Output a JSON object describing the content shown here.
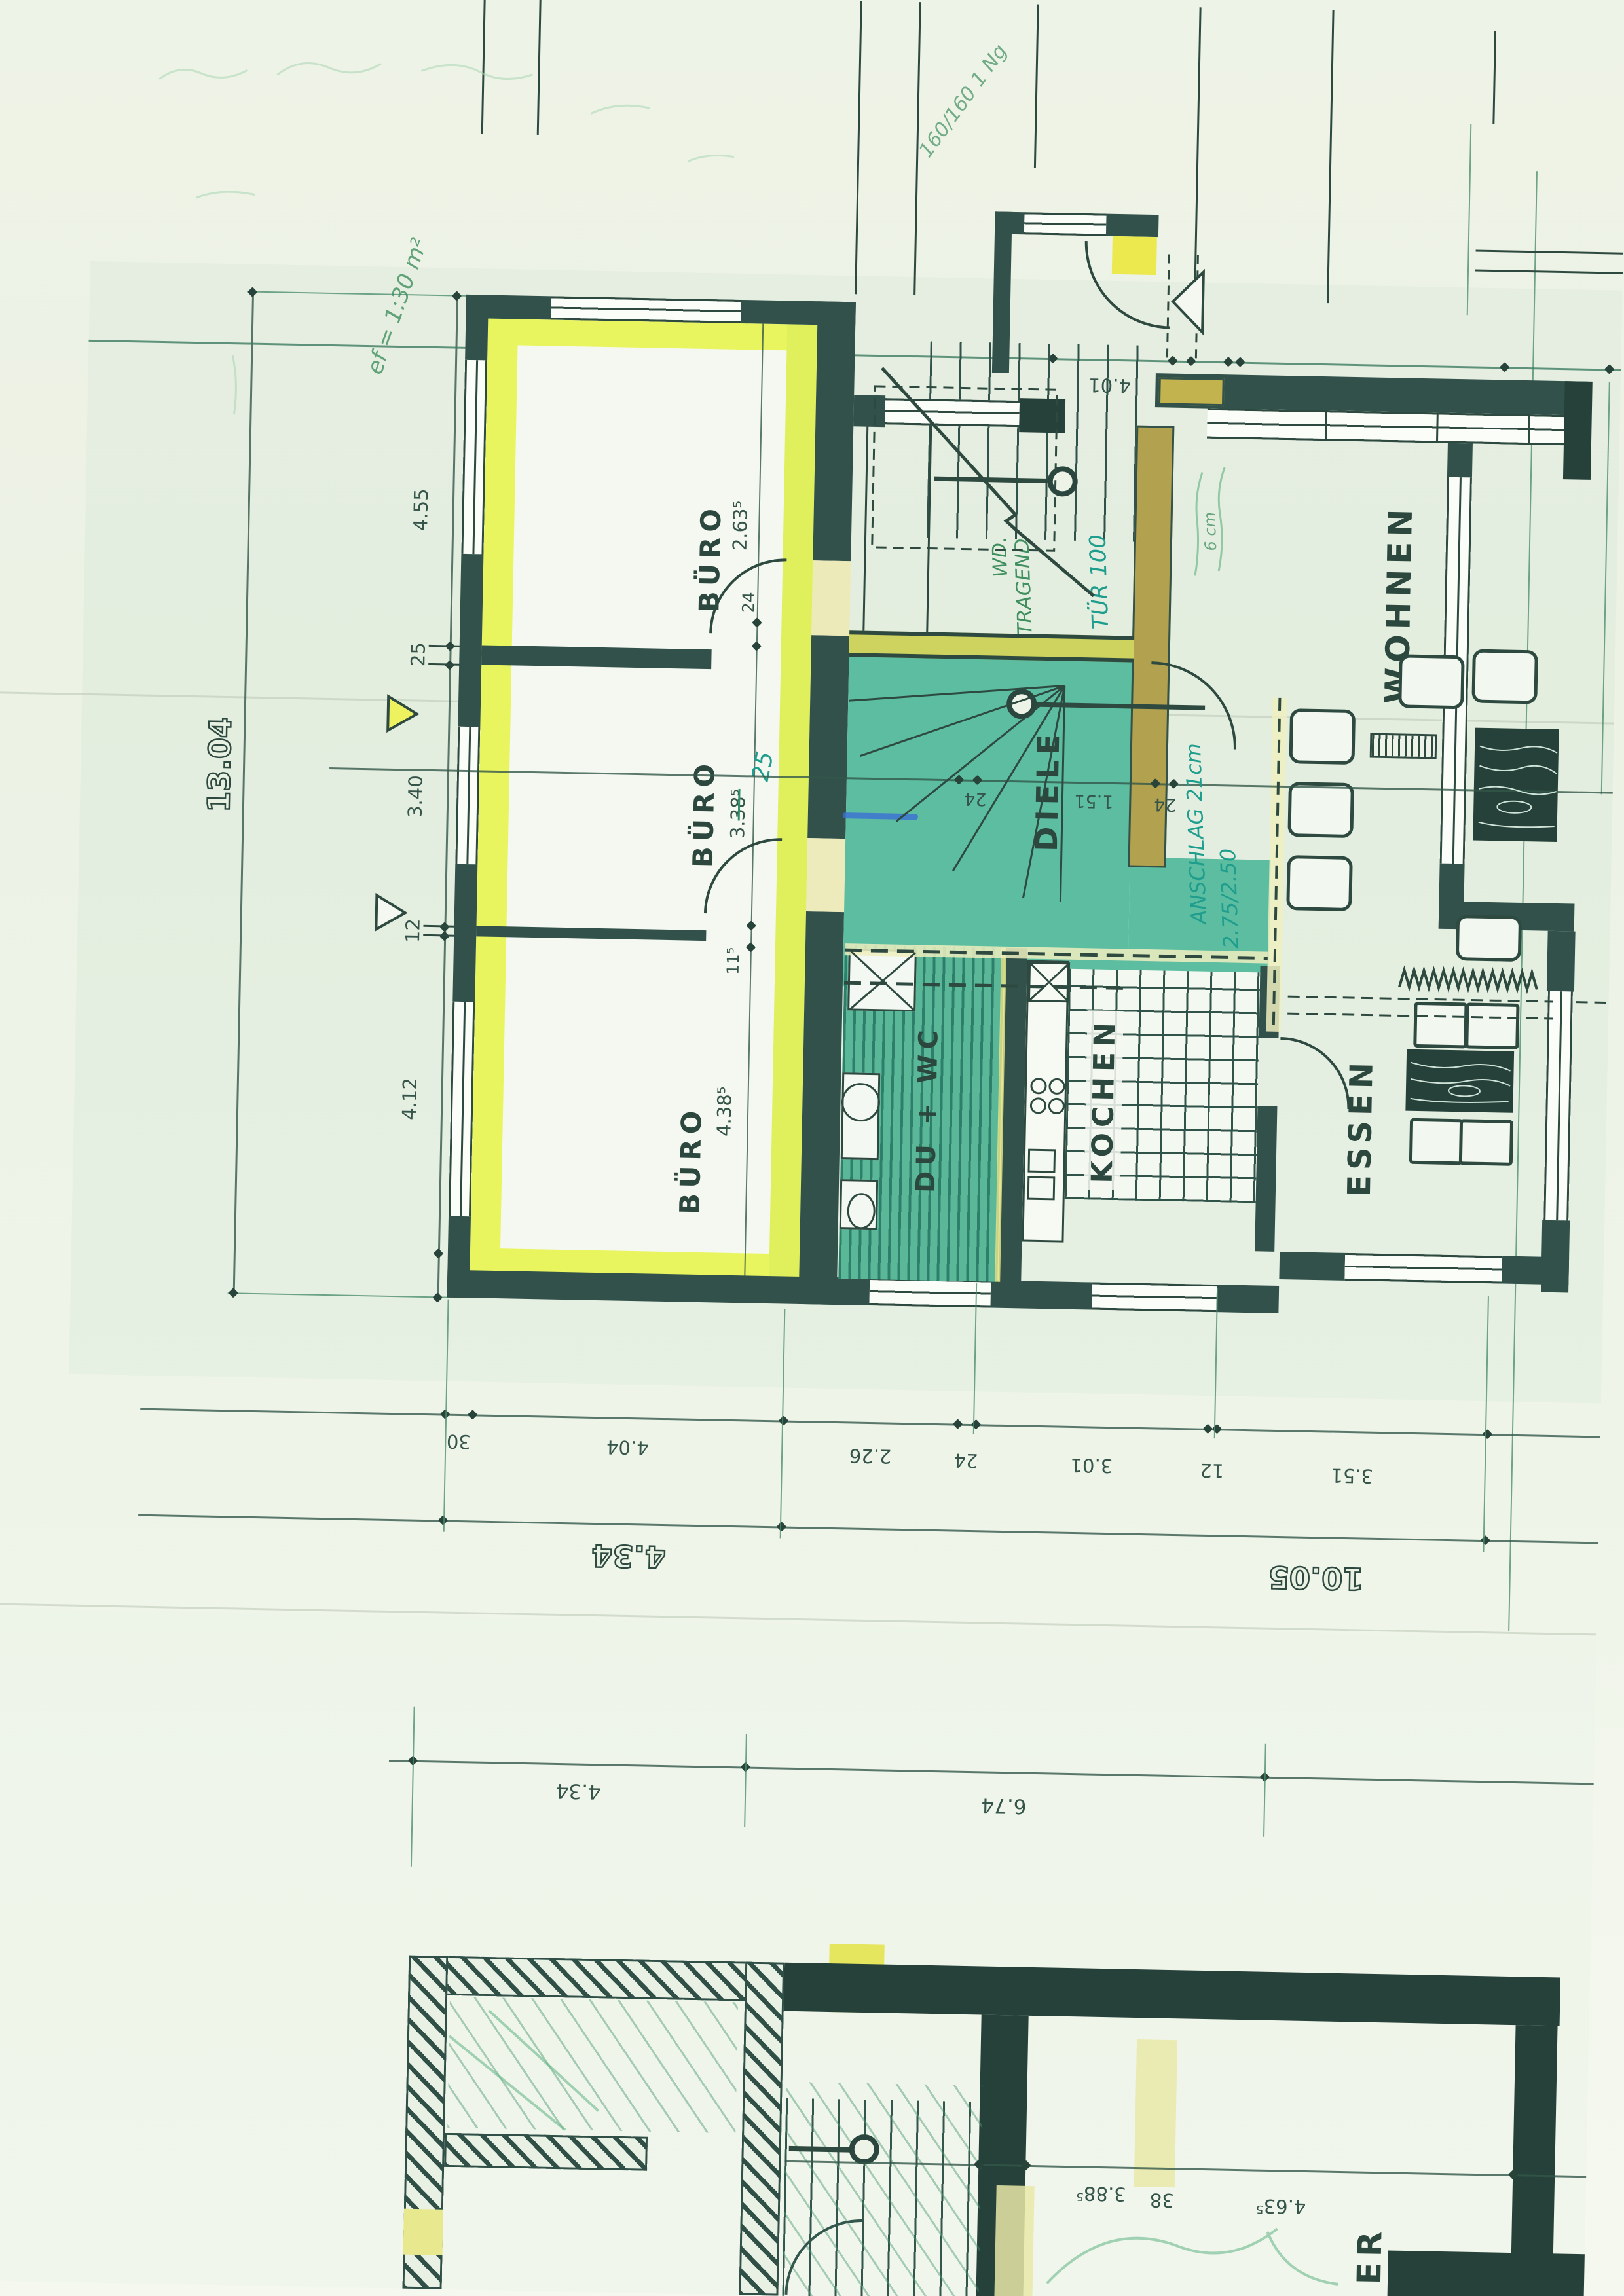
{
  "document": {
    "kind": "scanned architectural floor plan (photocopy, German)",
    "highlight_colors": {
      "office_wing": "#e9f55f",
      "hall_teal": "#5cbda1",
      "beam_ochre": "#b2a14e",
      "pen_green": "#3f8f5f",
      "pen_teal": "#1f9d8d",
      "ink": "#2e4a40"
    }
  },
  "rooms": [
    {
      "id": "buero-1",
      "label": "BÜRO"
    },
    {
      "id": "buero-2",
      "label": "BÜRO"
    },
    {
      "id": "buero-3",
      "label": "BÜRO"
    },
    {
      "id": "diele",
      "label": "DIELE"
    },
    {
      "id": "wohnen",
      "label": "WOHNEN"
    },
    {
      "id": "du-wc",
      "label": "DU + WC"
    },
    {
      "id": "kochen",
      "label": "KOCHEN"
    },
    {
      "id": "essen",
      "label": "ESSEN"
    },
    {
      "id": "basement-partial",
      "label": "ER"
    }
  ],
  "dimensions": {
    "left_outer": "13.04",
    "left_chain": [
      "4.55",
      "25",
      "3.40",
      "12",
      "4.12"
    ],
    "top_chain": [
      "4.01",
      "24",
      "4",
      "4.88⁵"
    ],
    "buero1": {
      "depth": "2.63⁵",
      "door_offset": "24"
    },
    "buero2": {
      "prefix": "3.",
      "struck": "38⁵",
      "correction": "25",
      "sill": "11⁵"
    },
    "buero3": {
      "depth": "4.38⁵"
    },
    "diele_chain": [
      "24",
      "1.51",
      "24"
    ],
    "bottom_chain": [
      "30",
      "4.04",
      "2.26",
      "24",
      "3.01",
      "12",
      "3.51"
    ],
    "bottom_totals": [
      "4.34",
      "10.05"
    ],
    "site_chain": [
      "4.34",
      "6.74"
    ],
    "basement_chain": [
      "3.88⁵",
      "38",
      "4.63⁵"
    ]
  },
  "annotations": {
    "corner_note": "160/160 1 Ng",
    "scale_note": "ef = 1:30 m²",
    "wall_note_1": "WD.",
    "wall_note_2": "TRAGEND",
    "door_note": "TÜR 100",
    "hinge_note_1": "ANSCHLAG 21cm",
    "hinge_note_2": "2.75/2.50",
    "pencil_note": "6 cm"
  }
}
